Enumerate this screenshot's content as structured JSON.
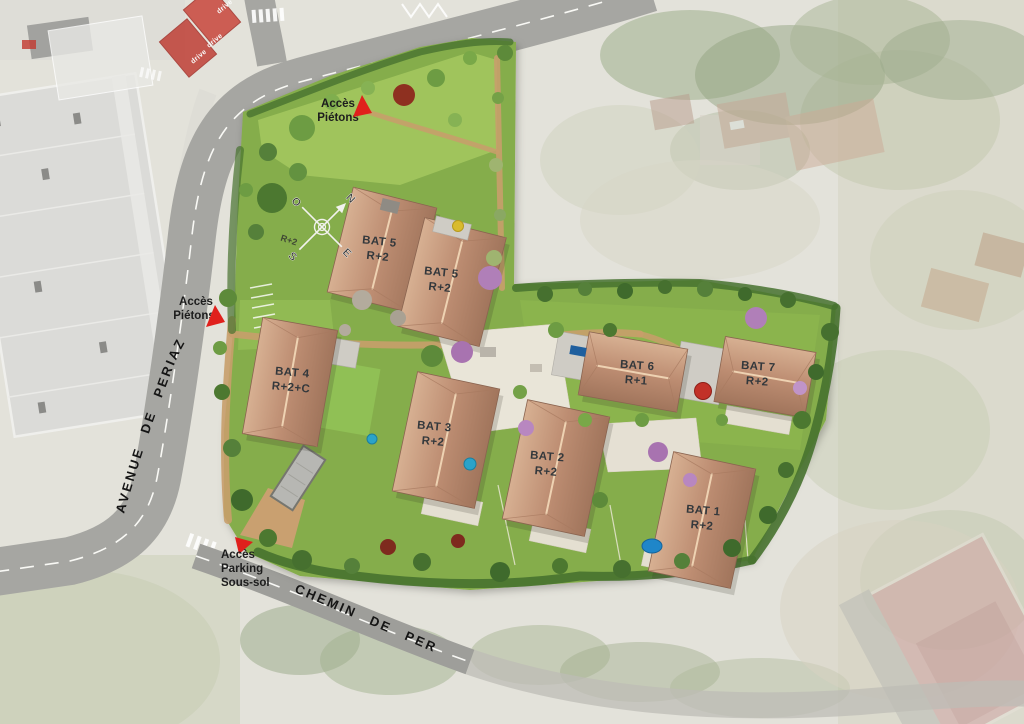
{
  "streets": {
    "avenue": "AVENUE DE PERIAZ",
    "chemin": "CHEMIN DE PERIAZ"
  },
  "buildings": [
    {
      "id": "bat1",
      "name": "BAT 1",
      "floors": "R+2"
    },
    {
      "id": "bat2",
      "name": "BAT 2",
      "floors": "R+2"
    },
    {
      "id": "bat3",
      "name": "BAT 3",
      "floors": "R+2"
    },
    {
      "id": "bat4",
      "name": "BAT 4",
      "floors": "R+2+C"
    },
    {
      "id": "bat5a",
      "name": "BAT 5",
      "floors": "R+2"
    },
    {
      "id": "bat5b",
      "name": "BAT 5",
      "floors": "R+2"
    },
    {
      "id": "bat6",
      "name": "BAT 6",
      "floors": "R+1"
    },
    {
      "id": "bat7",
      "name": "BAT 7",
      "floors": "R+2"
    }
  ],
  "annotations": {
    "pedestrian_access_top": {
      "line1": "Accès",
      "line2": "Piétons"
    },
    "pedestrian_access_left": {
      "line1": "Accès",
      "line2": "Piétons"
    },
    "parking_access": {
      "line1": "Accès",
      "line2": "Parking",
      "line3": "Sous-sol"
    },
    "small_floor_label": "R+2"
  },
  "compass": {
    "north": "N",
    "south": "S",
    "east": "E",
    "west": "O"
  },
  "background": {
    "drive_sign": "drive"
  },
  "colors": {
    "site_green": "#85ad4c",
    "meadow_green": "#a3c75e",
    "roof_terracotta": "#bd8d72",
    "accent_red": "#e0201c",
    "road_gray": "#a6a6a2",
    "path_tan": "#c89e6b",
    "hedge_green": "#47722f",
    "label_dark": "#33383c",
    "pool_blue": "#2ba3c9"
  }
}
